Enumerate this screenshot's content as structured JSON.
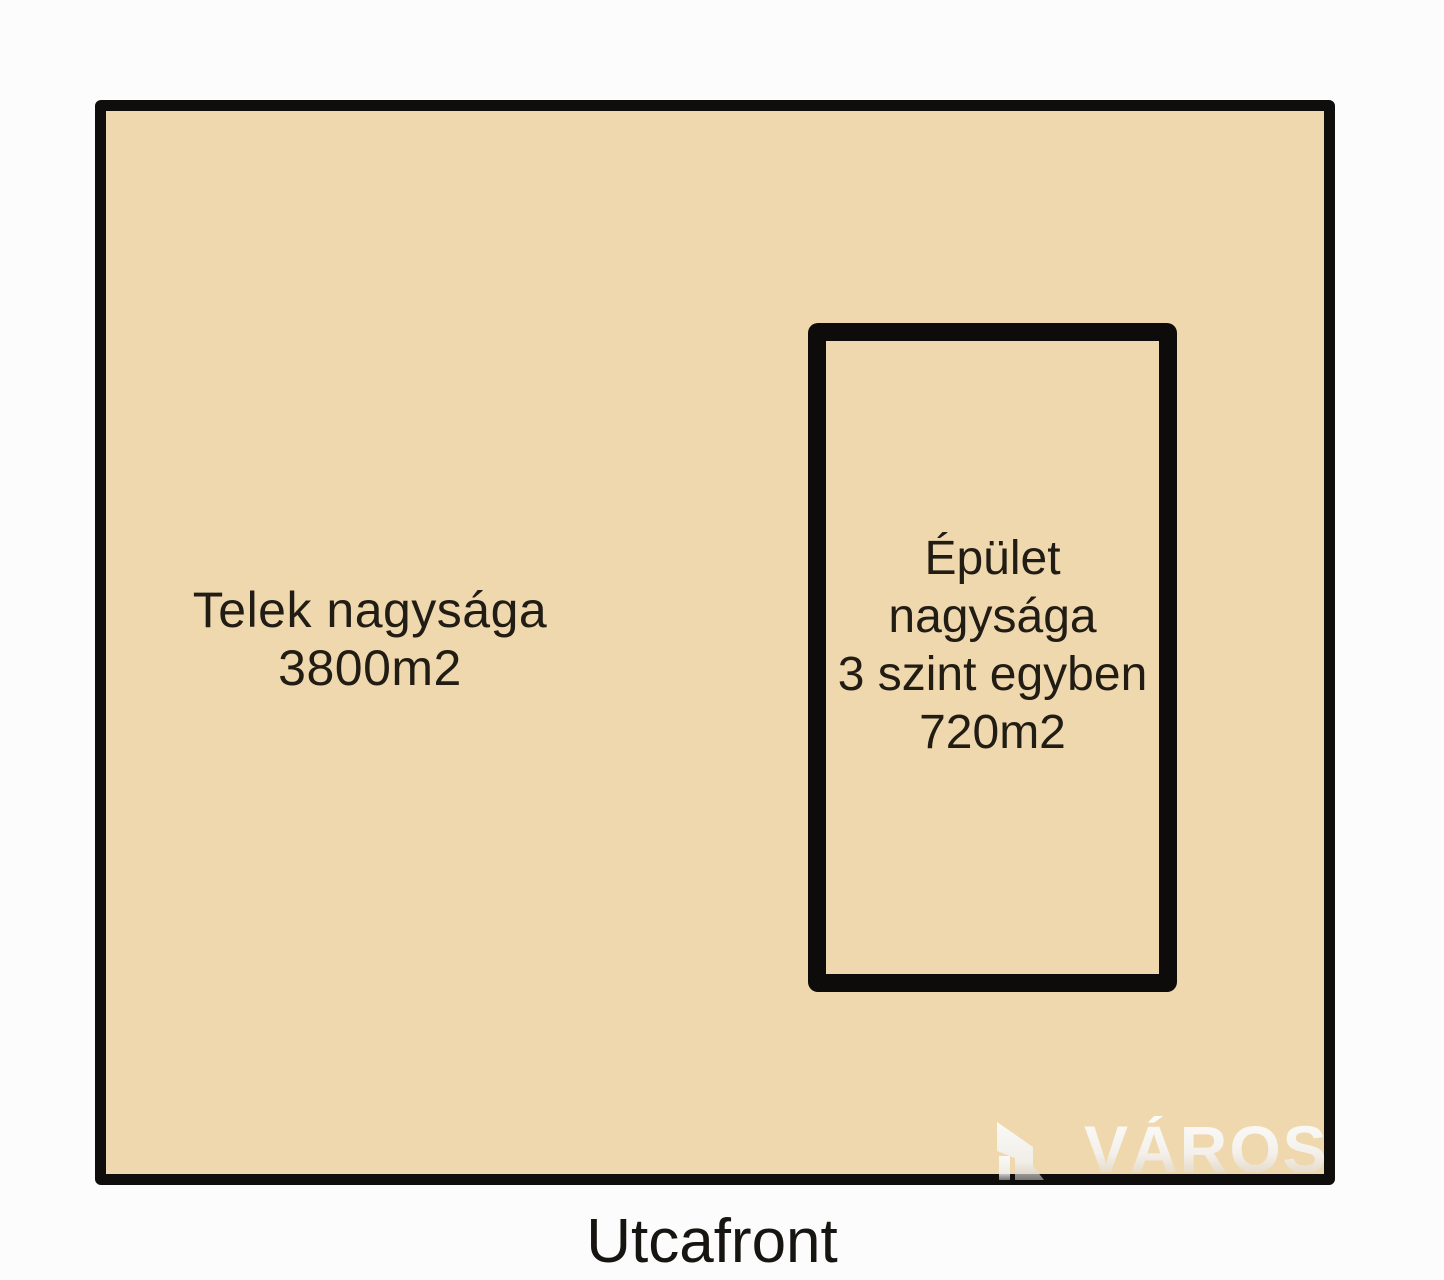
{
  "page": {
    "background_color": "#fcfcfc",
    "type": "site-plan-sketch"
  },
  "plot": {
    "fill_color": "#f0d8ae",
    "border_color": "#0f0e0c",
    "label_line1": "Telek nagysága",
    "label_line2": "3800m2"
  },
  "building": {
    "border_color": "#0d0c0a",
    "label_line1": "Épület",
    "label_line2": "nagysága",
    "label_line3": "3 szint egyben",
    "label_line4": "720m2"
  },
  "street": {
    "label": "Utcafront"
  },
  "watermark": {
    "text": "VÁROS",
    "icon": "building-logo",
    "color": "#f2f2f2"
  }
}
